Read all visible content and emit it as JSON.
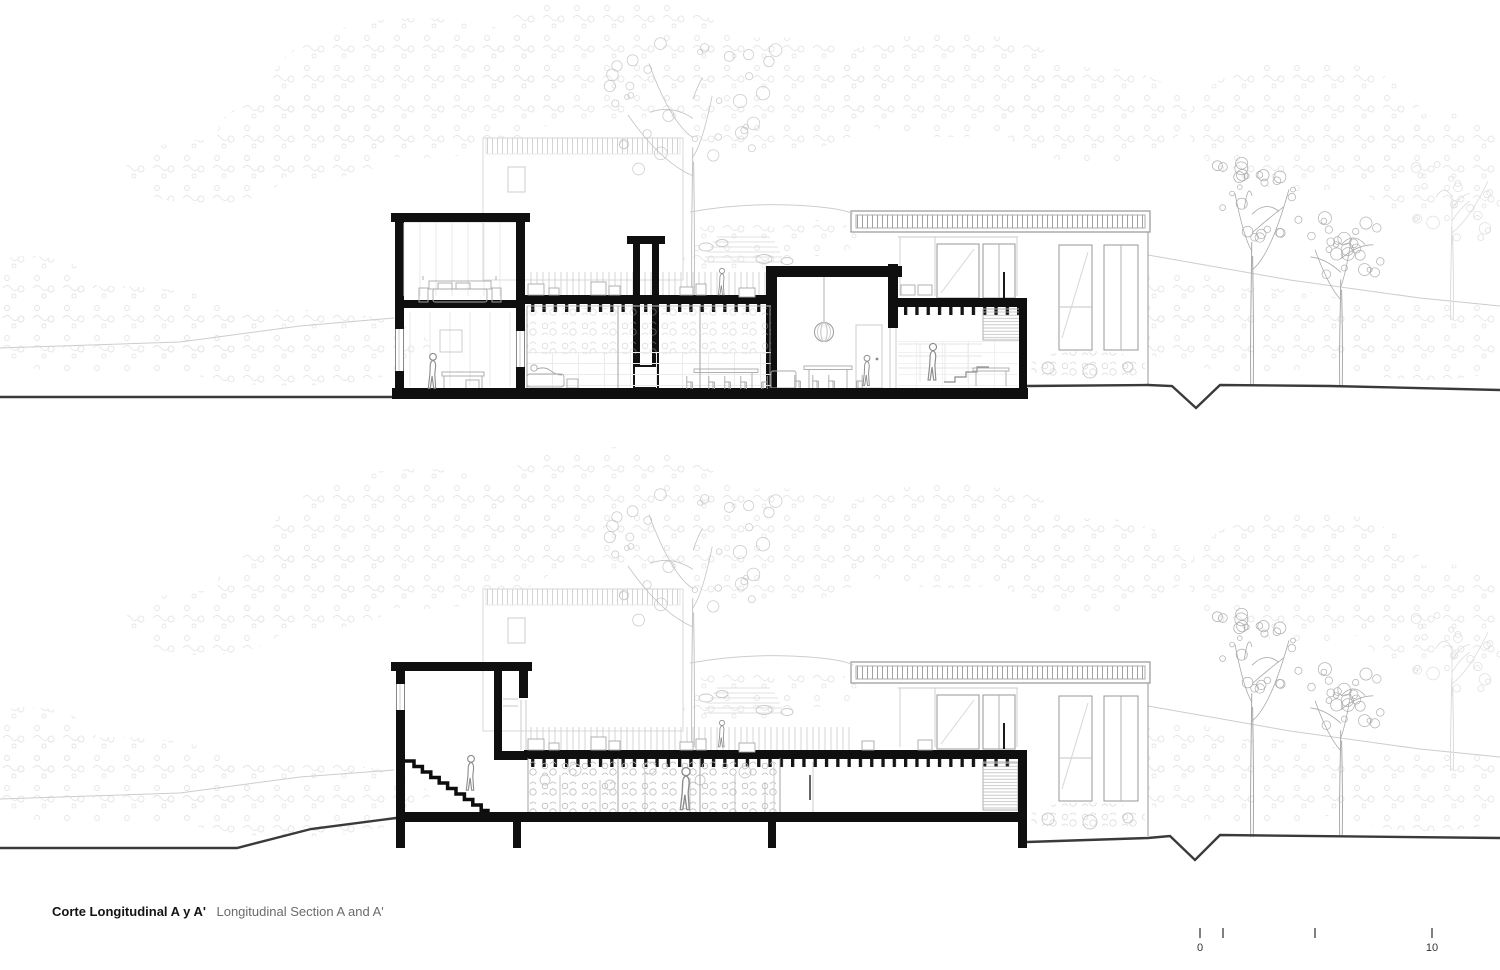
{
  "page": {
    "background": "#ffffff"
  },
  "caption": {
    "title_bold": "Corte Longitudinal A y A'",
    "title_regular": "Longitudinal Section A and A'"
  },
  "scale_bar": {
    "label_start": "0",
    "label_end": "10"
  },
  "colors": {
    "cut_black": "#0f0f0f",
    "ground_line": "#3a3a3a",
    "elevation_line": "#979797",
    "light_line": "#c9c9c9",
    "foliage_mist": "#e8e8e8",
    "foliage_leaf": "#b9b9b9",
    "tree_center": "#c4c4c4",
    "tree_right": "#a8a8a8"
  },
  "drawing": {
    "sections": [
      {
        "name": "upper-level-cut"
      },
      {
        "name": "lower-level-cut"
      }
    ],
    "dy_between_sections": 451,
    "blobs": [
      {
        "x": 420,
        "y": 88,
        "rx": 150,
        "ry": 70
      },
      {
        "x": 610,
        "y": 58,
        "rx": 130,
        "ry": 62
      },
      {
        "x": 772,
        "y": 95,
        "rx": 115,
        "ry": 58
      },
      {
        "x": 950,
        "y": 85,
        "rx": 130,
        "ry": 52
      },
      {
        "x": 1092,
        "y": 115,
        "rx": 95,
        "ry": 48
      },
      {
        "x": 312,
        "y": 135,
        "rx": 95,
        "ry": 44
      },
      {
        "x": 1306,
        "y": 125,
        "rx": 118,
        "ry": 66
      },
      {
        "x": 1442,
        "y": 168,
        "rx": 85,
        "ry": 55
      },
      {
        "x": 205,
        "y": 172,
        "rx": 80,
        "ry": 32
      },
      {
        "x": 108,
        "y": 330,
        "rx": 152,
        "ry": 44
      },
      {
        "x": 292,
        "y": 348,
        "rx": 138,
        "ry": 38
      },
      {
        "x": 28,
        "y": 292,
        "rx": 70,
        "ry": 36
      },
      {
        "x": 1256,
        "y": 330,
        "rx": 130,
        "ry": 42
      },
      {
        "x": 1426,
        "y": 340,
        "rx": 112,
        "ry": 40
      },
      {
        "x": 1180,
        "y": 298,
        "rx": 55,
        "ry": 26
      },
      {
        "x": 736,
        "y": 248,
        "rx": 62,
        "ry": 26
      },
      {
        "x": 816,
        "y": 238,
        "rx": 42,
        "ry": 18
      }
    ],
    "trees": [
      {
        "x": 693,
        "ground": 296,
        "h": 240,
        "crown": 88,
        "color": "#c4c4c4",
        "seed": 7,
        "n": 34
      },
      {
        "x": 1252,
        "ground": 386,
        "h": 232,
        "crown": 50,
        "color": "#a8a8a8",
        "seed": 3,
        "n": 26
      },
      {
        "x": 1341,
        "ground": 386,
        "h": 172,
        "crown": 42,
        "color": "#ababab",
        "seed": 11,
        "n": 24
      },
      {
        "x": 1452,
        "ground": 320,
        "h": 150,
        "crown": 55,
        "color": "#dcdcdc",
        "seed": 5,
        "n": 20
      }
    ],
    "figures": [
      {
        "g": "top",
        "x": 433,
        "y": 391,
        "h": 38,
        "role": "kitchen-person"
      },
      {
        "g": "top",
        "x": 722,
        "y": 297,
        "h": 29,
        "role": "deck-walker"
      },
      {
        "g": "top",
        "x": 867,
        "y": 388,
        "h": 33,
        "role": "dining-person"
      },
      {
        "g": "top",
        "x": 933,
        "y": 383,
        "h": 40,
        "role": "stair-person"
      },
      {
        "g": "bot",
        "x": 471,
        "y": 793,
        "h": 38,
        "role": "stair-walker"
      },
      {
        "g": "bot",
        "x": 686,
        "y": 813,
        "h": 46,
        "role": "corridor-walker"
      },
      {
        "g": "bot",
        "x": 722,
        "y": 749,
        "h": 29,
        "role": "deck-walker"
      }
    ],
    "deck_items_top": [
      [
        528,
        284,
        16,
        11
      ],
      [
        549,
        288,
        10,
        7
      ],
      [
        591,
        282,
        15,
        13
      ],
      [
        609,
        286,
        11,
        9
      ],
      [
        680,
        287,
        13,
        8
      ],
      [
        696,
        284,
        10,
        11
      ],
      [
        739,
        288,
        16,
        9
      ],
      [
        901,
        285,
        14,
        10
      ],
      [
        918,
        285,
        14,
        10
      ]
    ],
    "deck_items_bottom": [
      [
        528,
        739,
        16,
        11
      ],
      [
        549,
        743,
        10,
        7
      ],
      [
        591,
        737,
        15,
        13
      ],
      [
        609,
        741,
        11,
        9
      ],
      [
        680,
        742,
        13,
        8
      ],
      [
        696,
        739,
        10,
        11
      ],
      [
        739,
        743,
        16,
        9
      ],
      [
        862,
        741,
        12,
        9
      ],
      [
        918,
        740,
        14,
        10
      ]
    ],
    "chairs_top": [
      [
        686,
        389,
        0
      ],
      [
        708,
        389,
        0
      ],
      [
        724,
        389,
        0
      ],
      [
        740,
        389,
        0
      ],
      [
        761,
        389,
        1
      ],
      [
        794,
        388,
        0
      ],
      [
        812,
        388,
        0
      ],
      [
        828,
        388,
        0
      ],
      [
        856,
        388,
        1
      ]
    ]
  }
}
